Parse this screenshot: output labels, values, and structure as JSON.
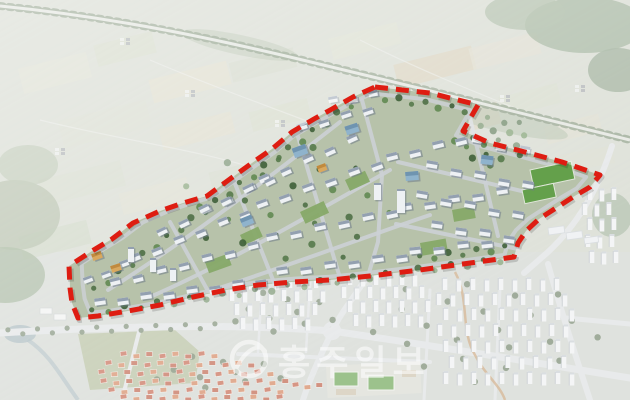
{
  "image": {
    "width": 630,
    "height": 400
  },
  "watermark": {
    "text": "홍주일보",
    "logo": "news-swoosh-logo",
    "color": "#ffffff",
    "opacity": 0.55,
    "font_size": 35,
    "letter_spacing": 6,
    "text_x": 278,
    "text_y": 375,
    "logo_cx": 249,
    "logo_cy": 359,
    "logo_r": 17
  },
  "boundary": {
    "color": "#de1d12",
    "shadow_color": "#000000",
    "stroke_width": 5,
    "dash": "13 8",
    "points": [
      [
        375,
        87
      ],
      [
        430,
        93
      ],
      [
        478,
        105
      ],
      [
        463,
        131
      ],
      [
        490,
        143
      ],
      [
        525,
        152
      ],
      [
        562,
        162
      ],
      [
        600,
        175
      ],
      [
        590,
        187
      ],
      [
        573,
        197
      ],
      [
        556,
        208
      ],
      [
        539,
        219
      ],
      [
        526,
        231
      ],
      [
        518,
        243
      ],
      [
        514,
        257
      ],
      [
        470,
        263
      ],
      [
        420,
        270
      ],
      [
        370,
        276
      ],
      [
        330,
        280
      ],
      [
        293,
        282
      ],
      [
        258,
        285
      ],
      [
        226,
        290
      ],
      [
        193,
        297
      ],
      [
        160,
        305
      ],
      [
        128,
        311
      ],
      [
        98,
        316
      ],
      [
        78,
        318
      ],
      [
        72,
        303
      ],
      [
        70,
        288
      ],
      [
        69,
        266
      ],
      [
        92,
        251
      ],
      [
        112,
        239
      ],
      [
        133,
        223
      ],
      [
        160,
        211
      ],
      [
        183,
        203
      ],
      [
        207,
        196
      ],
      [
        230,
        179
      ],
      [
        252,
        163
      ],
      [
        272,
        149
      ],
      [
        292,
        132
      ],
      [
        314,
        119
      ],
      [
        332,
        109
      ],
      [
        353,
        97
      ]
    ]
  },
  "palette": {
    "farm_base": "#cdd2c6",
    "city_base": "#ced3cc",
    "site_base": "#b7c2aa",
    "road_site": "#ccd0d5",
    "road_city": "#dcdfe0",
    "tree_road_trees": "#5e7656",
    "tree_road_pave": "#e6e8e2",
    "lawn": "#86a968",
    "sports_field": "#64a04b",
    "field_big": "#aab58e",
    "pond": "#8fa5ad",
    "trail": "#c08a52",
    "trees": [
      "#4f7046",
      "#628a52",
      "#3f6139",
      "#567a4b"
    ],
    "city_trees": "#5f7456",
    "wall": "#eef1f4",
    "roof": "#93a0b0",
    "bshadow": "#6f7b88",
    "glass_wall": "#8fb3cc",
    "glass_roof": "#6f94b0",
    "amber_wall": "#d9a85e",
    "amber_roof": "#c08a3e",
    "apt_wall": "#eef0f1",
    "apt_shade": "#a8afb5",
    "apt_roof": "#c6ccd0",
    "village_roofs": [
      "#c05a3e",
      "#cf7a50",
      "#b9543a"
    ],
    "hamlet_a": "#8f969b",
    "hamlet_b": "#e8eae8",
    "greenhouse": "#e9ecee",
    "school_base": "#d7d9cf",
    "school_bldg": "#cabfa8"
  },
  "wash": {
    "color": "#ffffff",
    "opacity": 0.36,
    "corner_fade_opacity": 0.28
  },
  "farmland": {
    "patches": [
      [
        20,
        60,
        70,
        26,
        -14,
        "#d4d6c3"
      ],
      [
        95,
        38,
        60,
        22,
        -14,
        "#c8cfba"
      ],
      [
        150,
        70,
        80,
        24,
        -14,
        "#d8d4be"
      ],
      [
        230,
        55,
        66,
        20,
        -14,
        "#c4ccb8"
      ],
      [
        60,
        110,
        90,
        28,
        -14,
        "#cdd3c0"
      ],
      [
        160,
        120,
        74,
        22,
        -14,
        "#d6d2bb"
      ],
      [
        250,
        105,
        60,
        20,
        -14,
        "#c9d0ba"
      ],
      [
        330,
        30,
        70,
        22,
        -14,
        "#d2d5c2"
      ],
      [
        395,
        55,
        80,
        24,
        -14,
        "#cfc3a6"
      ],
      [
        470,
        40,
        70,
        22,
        -14,
        "#d5d3c0"
      ],
      [
        350,
        90,
        64,
        20,
        -14,
        "#cdd2bf"
      ],
      [
        430,
        110,
        70,
        22,
        -14,
        "#d0c6ab"
      ],
      [
        40,
        170,
        84,
        26,
        -14,
        "#c8cfbc"
      ],
      [
        120,
        185,
        70,
        22,
        -14,
        "#d3d4c0"
      ],
      [
        210,
        165,
        62,
        20,
        -14,
        "#c7cebb"
      ],
      [
        300,
        145,
        56,
        18,
        -14,
        "#d6d4c1"
      ],
      [
        500,
        90,
        60,
        20,
        -14,
        "#cbd1bd"
      ],
      [
        545,
        120,
        56,
        18,
        -14,
        "#d4d2bf"
      ],
      [
        20,
        228,
        70,
        24,
        -14,
        "#bfc9b3"
      ],
      [
        88,
        240,
        60,
        20,
        -14,
        "#ccd2bf"
      ],
      [
        560,
        150,
        54,
        18,
        -10,
        "#cfd3c1"
      ]
    ],
    "woods": [
      [
        585,
        25,
        60,
        28,
        0,
        "#869c7f",
        0.85
      ],
      [
        525,
        12,
        40,
        18,
        0,
        "#92a78a",
        0.8
      ],
      [
        618,
        70,
        30,
        22,
        0,
        "#7f967a",
        0.85
      ],
      [
        15,
        215,
        45,
        35,
        0,
        "#9aaa8c",
        0.8
      ],
      [
        5,
        275,
        40,
        28,
        0,
        "#8aa07e",
        0.8
      ],
      [
        28,
        165,
        30,
        20,
        0,
        "#a3b296",
        0.7
      ],
      [
        495,
        118,
        75,
        12,
        14,
        "#97a98c",
        0.55
      ],
      [
        240,
        45,
        60,
        10,
        12,
        "#9cab90",
        0.5
      ],
      [
        612,
        215,
        20,
        22,
        0,
        "#8da487",
        0.7
      ]
    ],
    "roads": [
      "M 40 120 C 120 140 200 150 260 170",
      "M 150 60 C 220 90 280 110 330 130",
      "M 360 40 C 420 70 470 90 520 110"
    ],
    "hamlets": [
      [
        55,
        148
      ],
      [
        185,
        90
      ],
      [
        275,
        120
      ],
      [
        420,
        208
      ],
      [
        120,
        38
      ],
      [
        500,
        95
      ],
      [
        575,
        85
      ]
    ],
    "tree_road_path": "M 0 6 C 120 18 220 40 315 63 C 420 88 540 118 630 140"
  },
  "site": {
    "ring_inset": 0.05,
    "roads": [
      "M 108 290 C 180 245 260 185 340 122",
      "M 150 297 C 230 262 310 215 390 170",
      "M 210 291 C 300 262 370 235 430 215",
      "M 170 222 L 208 291",
      "M 232 176 L 275 285",
      "M 296 130 L 340 278",
      "M 362 100 L 382 175 L 378 242 L 368 276",
      "M 398 162 L 543 196",
      "M 396 224 L 518 249",
      "M 470 118 L 498 236"
    ],
    "building_rows": [
      [
        100,
        303,
        23,
        -3,
        8,
        11,
        7,
        -8
      ],
      [
        282,
        272,
        24,
        -3,
        6,
        11,
        7,
        -8
      ],
      [
        415,
        252,
        24,
        -3,
        4,
        11,
        7,
        -6
      ],
      [
        115,
        283,
        23,
        -6,
        7,
        10,
        7,
        -14
      ],
      [
        272,
        238,
        24,
        -5,
        6,
        11,
        7,
        -12
      ],
      [
        406,
        208,
        24,
        -4,
        5,
        11,
        7,
        -8
      ],
      [
        135,
        259,
        22,
        -9,
        6,
        10,
        7,
        -22
      ],
      [
        262,
        205,
        23,
        -8,
        6,
        11,
        7,
        -20
      ],
      [
        392,
        158,
        23,
        -6,
        4,
        11,
        7,
        -14
      ],
      [
        162,
        233,
        22,
        -11,
        5,
        10,
        6.5,
        -26
      ],
      [
        264,
        180,
        22,
        -10,
        5,
        10,
        7,
        -24
      ],
      [
        302,
        128,
        22,
        -6,
        4,
        10,
        6.5,
        -18
      ],
      [
        204,
        210,
        22,
        -10,
        4,
        10,
        6.5,
        -26
      ],
      [
        432,
        166,
        24,
        5,
        5,
        11,
        7,
        10
      ],
      [
        422,
        196,
        24,
        5,
        5,
        11,
        7,
        10
      ],
      [
        437,
        226,
        24,
        4,
        4,
        11,
        7,
        8
      ],
      [
        477,
        141,
        24,
        5,
        3,
        10,
        6.5,
        10
      ],
      [
        333,
        101,
        20,
        -3,
        3,
        9,
        6,
        -10
      ],
      [
        88,
        281,
        18,
        -8,
        3,
        9,
        6,
        -20
      ]
    ],
    "landmarks": [
      [
        300,
        151,
        14,
        10,
        -20,
        "glass"
      ],
      [
        352,
        129,
        13,
        9,
        -18,
        "glass"
      ],
      [
        412,
        176,
        13,
        9,
        -5,
        "glass"
      ],
      [
        247,
        221,
        12,
        9,
        -22,
        "glass"
      ],
      [
        487,
        160,
        12,
        9,
        8,
        "glass"
      ],
      [
        97,
        256,
        10,
        7,
        -20,
        "amber"
      ],
      [
        116,
        268,
        10,
        7,
        -18,
        "amber"
      ],
      [
        322,
        168,
        9,
        7,
        -20,
        "amber"
      ]
    ],
    "towers": [
      [
        397,
        213,
        8,
        24
      ],
      [
        374,
        200,
        7,
        17
      ],
      [
        128,
        262,
        6,
        15
      ],
      [
        150,
        272,
        6,
        14
      ],
      [
        170,
        281,
        6,
        13
      ]
    ],
    "lawns": [
      [
        300,
        212,
        26,
        13,
        -25
      ],
      [
        205,
        262,
        24,
        12,
        -20
      ],
      [
        420,
        243,
        26,
        13,
        -10
      ],
      [
        452,
        210,
        22,
        12,
        -10
      ],
      [
        345,
        180,
        22,
        12,
        -25
      ],
      [
        240,
        235,
        20,
        11,
        -25
      ]
    ],
    "sports_fields": [
      [
        530,
        170,
        42,
        18,
        -12
      ],
      [
        522,
        190,
        32,
        14,
        -12
      ]
    ],
    "tree_lines": [
      [
        95,
        290,
        350,
        105,
        22
      ],
      [
        92,
        312,
        500,
        260,
        26
      ],
      [
        372,
        96,
        465,
        110,
        8
      ],
      [
        420,
        258,
        505,
        248,
        7
      ]
    ],
    "tree_scatters": [
      [
        492,
        140,
        40,
        26,
        20
      ],
      [
        290,
        205,
        110,
        62,
        26
      ]
    ]
  },
  "city": {
    "roads": [
      [
        "M 0 333 C 120 326 240 324 332 331",
        7
      ],
      [
        "M 332 331 C 430 345 530 362 630 378",
        7
      ],
      [
        "M 367 277 C 352 300 340 314 333 330 C 322 352 310 378 303 400",
        6
      ],
      [
        "M 548 264 C 558 300 572 345 590 400",
        6
      ],
      [
        "M 566 318 L 630 324",
        5
      ],
      [
        "M 612 146 C 598 190 576 226 548 252 C 540 259 532 266 524 273",
        6
      ],
      [
        "M 140 328 L 122 400",
        4
      ],
      [
        "M 262 286 L 258 352",
        2.5
      ],
      [
        "M 310 283 L 306 352",
        2.5
      ],
      [
        "M 238 354 L 430 362",
        4
      ],
      [
        "M 430 290 L 424 400",
        3
      ],
      [
        "M 500 288 L 495 400",
        3
      ]
    ],
    "roundabout": [
      332,
      331,
      7
    ],
    "trail": "M 455 272 C 470 300 460 330 475 355 C 485 375 500 385 505 400",
    "apartment_rows": [
      [
        288,
        238,
        7,
        13
      ],
      [
        301,
        232,
        8,
        13
      ],
      [
        315,
        237,
        7,
        13
      ],
      [
        329,
        243,
        6,
        13
      ],
      [
        285,
        350,
        6,
        13
      ],
      [
        298,
        344,
        7,
        13
      ],
      [
        312,
        350,
        7,
        13
      ],
      [
        326,
        356,
        6,
        13
      ],
      [
        290,
        445,
        9,
        14
      ],
      [
        305,
        439,
        10,
        14
      ],
      [
        320,
        446,
        10,
        14
      ],
      [
        336,
        440,
        10,
        14
      ],
      [
        352,
        446,
        10,
        14
      ],
      [
        368,
        452,
        9,
        14
      ],
      [
        384,
        446,
        10,
        14
      ],
      [
        200,
        590,
        3,
        12
      ],
      [
        215,
        585,
        3,
        12
      ],
      [
        230,
        590,
        3,
        12
      ],
      [
        247,
        588,
        3,
        12
      ],
      [
        263,
        592,
        3,
        12
      ]
    ],
    "village_rows": [
      [
        353,
        120,
        8,
        13
      ],
      [
        362,
        105,
        12,
        13
      ],
      [
        371,
        98,
        14,
        13
      ],
      [
        380,
        100,
        15,
        13
      ],
      [
        389,
        108,
        14,
        13
      ],
      [
        396,
        120,
        13,
        13
      ],
      [
        384,
        292,
        3,
        12
      ]
    ],
    "school": {
      "base": [
        326,
        366,
        94,
        32,
        -3
      ],
      "fields": [
        [
          334,
          372,
          24,
          14
        ],
        [
          368,
          376,
          26,
          14
        ]
      ],
      "buildings": [
        [
          402,
          370,
          14,
          7
        ],
        [
          336,
          389,
          20,
          6
        ]
      ]
    },
    "greenhouses": [
      [
        548,
        228,
        16,
        7
      ],
      [
        566,
        233,
        16,
        7
      ],
      [
        584,
        238,
        14,
        6
      ]
    ],
    "pond": [
      20,
      334,
      16,
      9
    ],
    "stream": "M 28 340 C 50 355 60 375 78 400",
    "big_field": "78,334 175,330 200,352 195,383 90,390",
    "small_warehouses": [
      [
        40,
        308
      ],
      [
        54,
        314
      ]
    ],
    "tree_lines": [
      [
        8,
        332,
        215,
        326,
        15
      ]
    ],
    "tree_scatters": [
      [
        480,
        330,
        120,
        55,
        22
      ],
      [
        285,
        312,
        55,
        25,
        10
      ],
      [
        220,
        372,
        70,
        20,
        10
      ]
    ]
  }
}
